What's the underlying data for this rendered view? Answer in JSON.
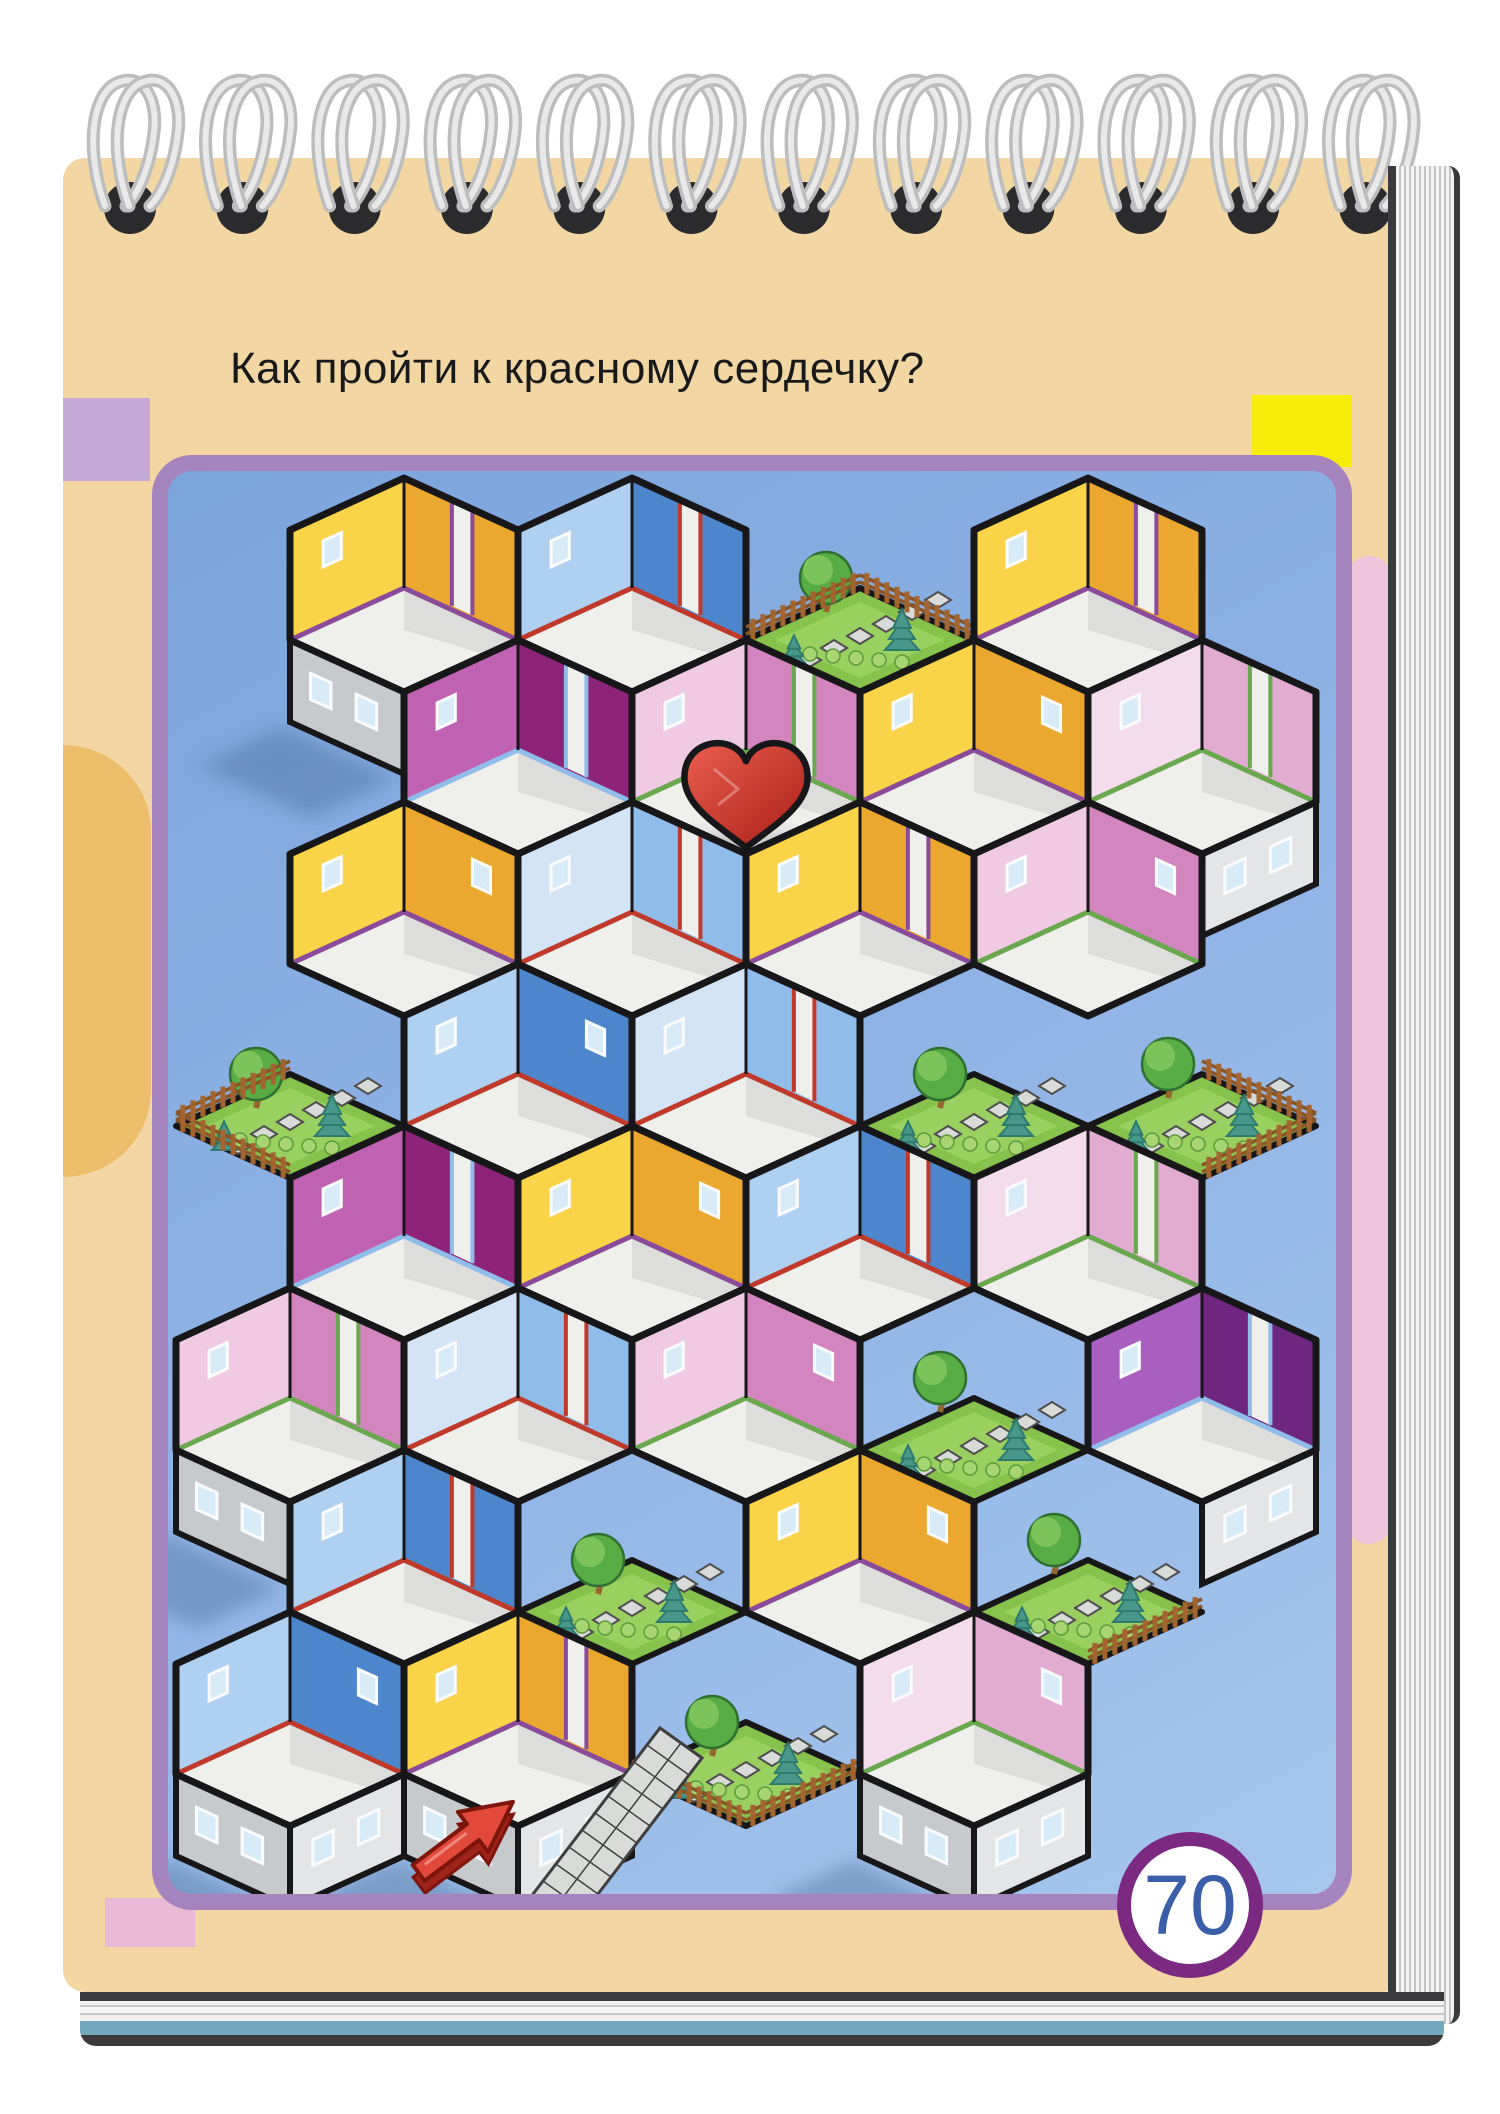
{
  "page": {
    "title": "Как пройти к красному сердечку?",
    "page_number": "70",
    "language": "ru"
  },
  "notebook": {
    "spiral_count": 12,
    "paper_color": "#F2D7A4",
    "wire_color": "#CFCFCF",
    "hole_color": "#2B2B2D",
    "edge_blue_stripe": "#74A8BC"
  },
  "decor": {
    "lilac_rect": "#C7A9D6",
    "yellow_rect": "#F6EE0A",
    "pink_rect": "#E9BAD6",
    "pink_blob": "#EDC6DD",
    "orange_blob": "#ECBE6B"
  },
  "puzzle": {
    "type": "isometric-room-maze",
    "goal_icon": "red-heart",
    "start_icon": "red-arrow",
    "panel": {
      "border": "#A583BD",
      "bg_top": "#7CA5DC",
      "bg_bottom": "#A6C6EC"
    },
    "grid": {
      "origin_x": 404,
      "origin_y": 478,
      "step_x": 114,
      "step_y": 162,
      "half_w": 114,
      "half_h": 52,
      "wall_h": 110,
      "ext_h": 82
    },
    "room_floor": "#EFEFEC",
    "outline": "#17171A",
    "exterior": {
      "sw": "#C7CACC",
      "se": "#E3E5E6",
      "window": "#D8EBF8",
      "frame": "#FAFBFC"
    },
    "palettes": {
      "yellow": {
        "light": "#F9D348",
        "dark": "#EBA72E",
        "trim": "#8A4B9A"
      },
      "blue": {
        "light": "#AFD0F0",
        "dark": "#4D86CC",
        "trim": "#C03A2B"
      },
      "lightblue": {
        "light": "#D3E4F7",
        "dark": "#8FBCE9",
        "trim": "#C03A2B"
      },
      "magenta": {
        "light": "#C062B1",
        "dark": "#8E2478",
        "trim": "#8FBCE9"
      },
      "pink": {
        "light": "#F0CAE2",
        "dark": "#D285BE",
        "trim": "#69A84F"
      },
      "palepink": {
        "light": "#F5DCEC",
        "dark": "#E2ACD2",
        "trim": "#69A84F"
      },
      "purple": {
        "light": "#A95FBF",
        "dark": "#6E2680",
        "trim": "#8FBCE9"
      }
    },
    "garden": {
      "grass": "#86C24C",
      "grass_hi": "#9AD05F",
      "canopy": "#58AC44",
      "canopy_hi": "#7CC35A",
      "canopy_edge": "#2F7030",
      "pine": "#47978A",
      "pine_edge": "#2E7A6E",
      "trunk": "#96662F",
      "fence": "#A3652F",
      "fence_rail": "#8A5526",
      "shrub": "#A7D56F",
      "shrub_edge": "#5F9B3C",
      "tile": "#D9DBD9",
      "tile_edge": "#4E4E4E"
    },
    "heart": {
      "cell_c": 3,
      "cell_r": 1,
      "grad_light": "#EA5D4F",
      "grad_dark": "#AB1E17"
    },
    "entrance": {
      "arrow_x": 465,
      "arrow_y": 1838,
      "arrow_angle": -37,
      "path_x1": 530,
      "path_y1": 1898,
      "path_x2": 660,
      "path_y2": 1728,
      "arrow_fill": "#E2493B",
      "arrow_side": "#9E231A",
      "arrow_edge": "#7E150D"
    },
    "cells": [
      {
        "c": 0,
        "r": 0,
        "p": "yellow"
      },
      {
        "c": 2,
        "r": 0,
        "p": "blue"
      },
      {
        "c": 4,
        "r": 0,
        "p": "garden"
      },
      {
        "c": 6,
        "r": 0,
        "p": "yellow"
      },
      {
        "c": 1,
        "r": 1,
        "p": "magenta"
      },
      {
        "c": 3,
        "r": 1,
        "p": "pink",
        "heart": true
      },
      {
        "c": 5,
        "r": 1,
        "p": "yellow"
      },
      {
        "c": 7,
        "r": 1,
        "p": "palepink"
      },
      {
        "c": 0,
        "r": 2,
        "p": "yellow"
      },
      {
        "c": 2,
        "r": 2,
        "p": "lightblue"
      },
      {
        "c": 4,
        "r": 2,
        "p": "yellow"
      },
      {
        "c": 6,
        "r": 2,
        "p": "pink"
      },
      {
        "c": -1,
        "r": 3,
        "p": "garden"
      },
      {
        "c": 1,
        "r": 3,
        "p": "blue"
      },
      {
        "c": 3,
        "r": 3,
        "p": "lightblue"
      },
      {
        "c": 5,
        "r": 3,
        "p": "garden"
      },
      {
        "c": 7,
        "r": 3,
        "p": "garden"
      },
      {
        "c": 0,
        "r": 4,
        "p": "magenta"
      },
      {
        "c": 2,
        "r": 4,
        "p": "yellow"
      },
      {
        "c": 4,
        "r": 4,
        "p": "blue"
      },
      {
        "c": 6,
        "r": 4,
        "p": "palepink"
      },
      {
        "c": -1,
        "r": 5,
        "p": "pink"
      },
      {
        "c": 1,
        "r": 5,
        "p": "lightblue"
      },
      {
        "c": 3,
        "r": 5,
        "p": "pink"
      },
      {
        "c": 5,
        "r": 5,
        "p": "garden"
      },
      {
        "c": 7,
        "r": 5,
        "p": "purple"
      },
      {
        "c": 0,
        "r": 6,
        "p": "blue"
      },
      {
        "c": 2,
        "r": 6,
        "p": "garden"
      },
      {
        "c": 4,
        "r": 6,
        "p": "yellow"
      },
      {
        "c": 6,
        "r": 6,
        "p": "garden"
      },
      {
        "c": -1,
        "r": 7,
        "p": "blue"
      },
      {
        "c": 1,
        "r": 7,
        "p": "yellow"
      },
      {
        "c": 3,
        "r": 7,
        "p": "garden"
      },
      {
        "c": 5,
        "r": 7,
        "p": "palepink"
      }
    ]
  }
}
